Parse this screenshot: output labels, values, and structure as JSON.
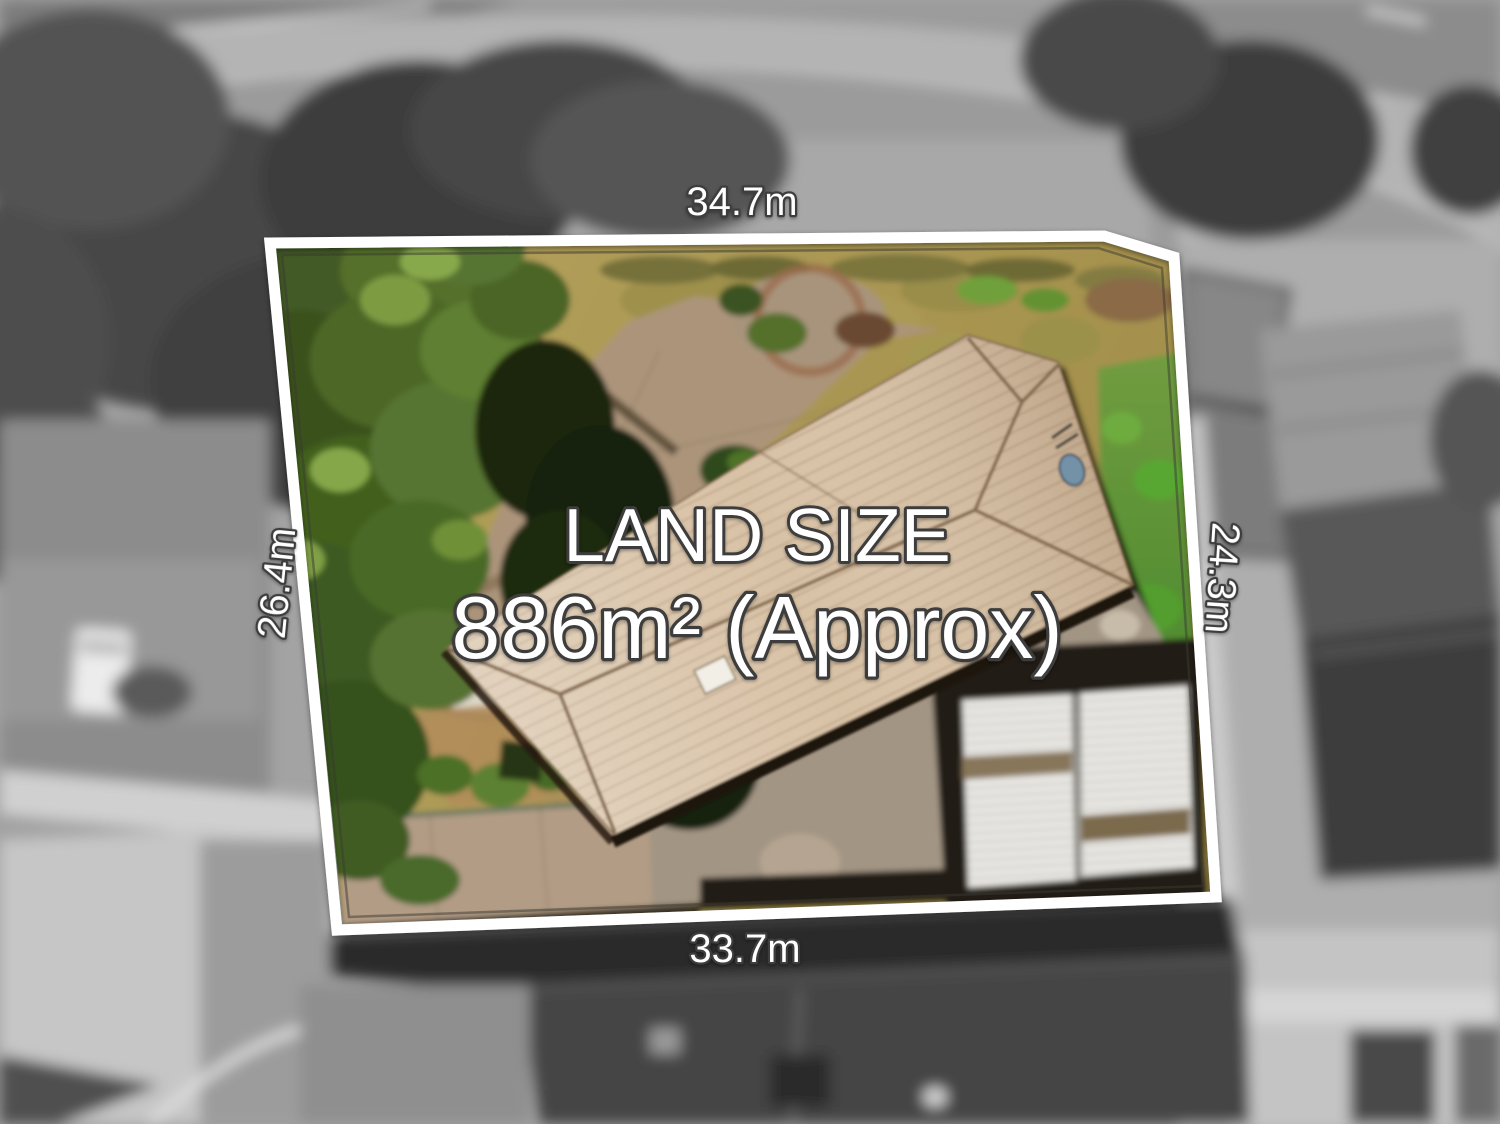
{
  "overlay": {
    "land_size_title": "LAND SIZE",
    "land_size_value": "886m² (Approx)",
    "dimensions": {
      "top": "34.7m",
      "left": "26.4m",
      "right": "24.3m",
      "bottom": "33.7m"
    },
    "colors": {
      "boundary_line": "#ffffff",
      "label_text": "#ffffff",
      "label_outline": "#3c3c3c"
    }
  }
}
